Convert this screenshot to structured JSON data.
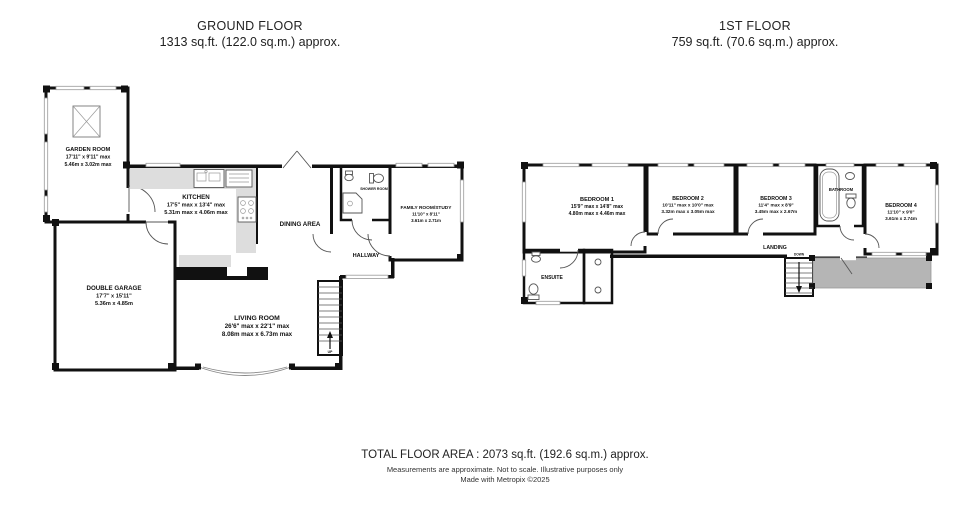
{
  "titles": {
    "ground": {
      "name": "GROUND FLOOR",
      "area": "1313 sq.ft. (122.0 sq.m.) approx."
    },
    "first": {
      "name": "1ST FLOOR",
      "area": "759 sq.ft. (70.6 sq.m.) approx."
    }
  },
  "ground_floor": {
    "garden_room": {
      "name": "GARDEN ROOM",
      "imperial": "17'11\" x 9'11\" max",
      "metric": "5.46m x 3.02m max"
    },
    "kitchen": {
      "name": "KITCHEN",
      "imperial": "17'5\" max x 13'4\" max",
      "metric": "5.31m max x 4.06m max"
    },
    "dining_area": {
      "name": "DINING AREA"
    },
    "shower_room": {
      "name": "SHOWER ROOM"
    },
    "family_room": {
      "name": "FAMILY ROOM/STUDY",
      "imperial": "11'10\" x 8'11\"",
      "metric": "3.61m x 2.71m"
    },
    "hallway": {
      "name": "HALLWAY"
    },
    "double_garage": {
      "name": "DOUBLE GARAGE",
      "imperial": "17'7\" x 15'11\"",
      "metric": "5.36m x 4.85m"
    },
    "living_room": {
      "name": "LIVING ROOM",
      "imperial": "26'6\" max x 22'1\" max",
      "metric": "8.08m max x 6.73m max"
    },
    "stairs_label": "UP"
  },
  "first_floor": {
    "bedroom1": {
      "name": "BEDROOM 1",
      "imperial": "15'9\" max x 14'8\" max",
      "metric": "4.80m max x 4.46m max"
    },
    "bedroom2": {
      "name": "BEDROOM 2",
      "imperial": "10'11\" max x 10'0\" max",
      "metric": "3.32m max x 3.05m max"
    },
    "bedroom3": {
      "name": "BEDROOM 3",
      "imperial": "11'4\" max x 8'9\"",
      "metric": "3.45m max x 2.67m"
    },
    "bedroom4": {
      "name": "BEDROOM 4",
      "imperial": "11'10\" x 9'0\"",
      "metric": "3.61m x 2.74m"
    },
    "bathroom": {
      "name": "BATHROOM"
    },
    "ensuite": {
      "name": "ENSUITE"
    },
    "landing": {
      "name": "LANDING"
    },
    "stairs_label": "DOWN"
  },
  "footer": {
    "total": "TOTAL FLOOR AREA : 2073 sq.ft. (192.6 sq.m.) approx.",
    "disclaimer": "Measurements are approximate.  Not to scale.  Illustrative purposes only",
    "credit": "Made with Metropix ©2025"
  },
  "colors": {
    "wall": "#111111",
    "counter": "#dddddd",
    "roof_shade": "#b5b5b5",
    "window": "#999999"
  }
}
